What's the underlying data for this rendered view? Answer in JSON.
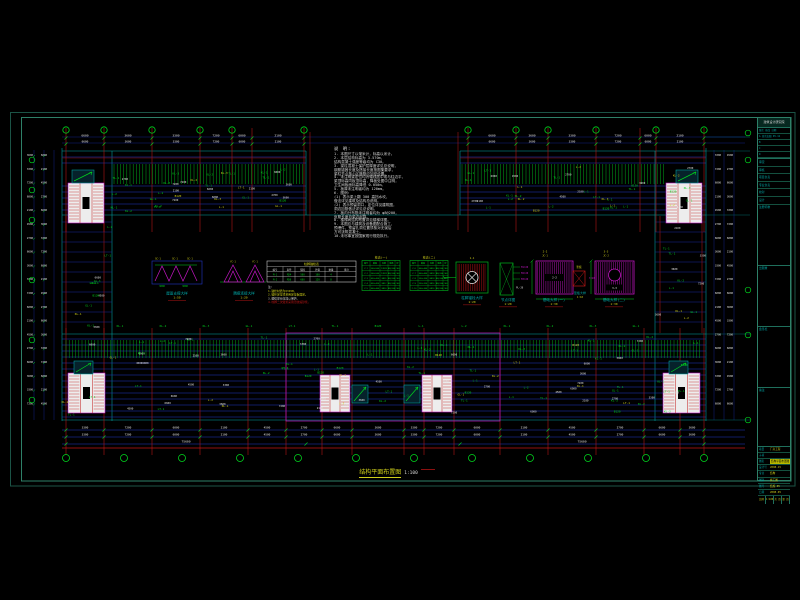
{
  "colors": {
    "bg": "#000000",
    "blue": "#2136c8",
    "blue_dim": "#17279c",
    "cyan": "#00a8a8",
    "teal_outer": "#1b5346",
    "teal_inner": "#2e8068",
    "red": "#c21616",
    "dark_red": "#8c1010",
    "green": "#00b41e",
    "green_bright": "#00d41e",
    "magenta": "#c316c3",
    "yellow": "#cfcf1a",
    "white": "#e0e0e0"
  },
  "notes": {
    "heading": "说 明:",
    "lines": [
      "1. 本图尺寸以毫米计，标高以米计。",
      "2. 本层结构标高为 3.570m，",
      "   结构混凝土强度等级均为 C30。",
      "3. 梁柱混凝土保护层厚度详见总说明，",
      "   钢筋锚固长度及搭接长度按图集要求，",
      "   梁柱节点核心区箍筋应加密设置。",
      "4. 未注明梁定位均为轴线居中或与柱边平，",
      "   梁顶标高同板顶标高，降板处图中注明，",
      "   卫生间板面标高降低 0.050m。",
      "5. 板厚未注明者均为 120mm。",
      "6. 图例:",
      "   (1) 表示梁上翻 300 高挡水坎，",
      "       做法详见建筑及结构总说明。",
      "   (2) 表示预留洞口，定位详见建筑图，",
      "       洞边加筋做法详见总说明。",
      "7. 板内分布筋未注明者均为 φ8@200，",
      "   负筋长度自梁边起算。",
      "8. 楼梯间结构布置详见楼梯详图。",
      "9. 本图应与建筑及设备图配合施工，",
      "   预埋件、预留孔洞位置须核对无误后",
      "   方可浇筑混凝土。",
      "10.未尽事宜按国家现行规范执行。"
    ]
  },
  "title": {
    "text": "结构平面布置图",
    "scale": "1:100"
  },
  "details": {
    "captions": [
      {
        "label": "屋面支撑大样",
        "scale": "1:50"
      },
      {
        "label": "隅撑连接大样",
        "scale": "1:20"
      },
      {
        "label": "柱脚锚栓大样",
        "scale": "1:20"
      },
      {
        "label": "节点详图",
        "scale": "1:20"
      },
      {
        "label": "基础大样(一)",
        "scale": "1:30"
      },
      {
        "label": "垫板大样",
        "scale": "1:10"
      },
      {
        "label": "基础大样(二)",
        "scale": "1:30"
      }
    ],
    "callouts": [
      "1-1",
      "2-2",
      "3-3"
    ],
    "plate_labels": [
      "2-2",
      "3-3"
    ],
    "pad_label": "垫板",
    "pad_note": "t=20"
  },
  "bolt_table": {
    "title": "柱脚锚栓表",
    "headers": [
      "编号",
      "直径",
      "锚固",
      "外露",
      "数量",
      "备注"
    ],
    "rows": [
      [
        "M-1",
        "M24",
        "500",
        "100",
        "4",
        ""
      ],
      [
        "M-2",
        "M30",
        "600",
        "120",
        "8",
        ""
      ]
    ],
    "notes": [
      "注:",
      "1.锚栓材质为Q345B。",
      "2.锚栓定位须采用定位板固定。",
      "3.螺纹部分应加以保护。",
      "4.柱脚二次灌浆采用无收缩砂浆。"
    ]
  },
  "column_tables": [
    {
      "title": "柱表(一)",
      "rows": [
        [
          "编号",
          "截面",
          "纵筋",
          "箍筋",
          "砼"
        ],
        [
          "Z-1",
          "500×500",
          "12Φ25",
          "Φ8@100",
          "C40"
        ],
        [
          "Z-2",
          "500×500",
          "12Φ22",
          "Φ8@100",
          "C40"
        ],
        [
          "Z-3",
          "450×450",
          "8Φ25",
          "Φ8@100",
          "C40"
        ],
        [
          "Z-4",
          "450×450",
          "8Φ22",
          "Φ8@100",
          "C40"
        ],
        [
          "Z-5",
          "400×400",
          "8Φ20",
          "Φ8@100",
          "C40"
        ]
      ]
    },
    {
      "title": "柱表(二)",
      "rows": [
        [
          "编号",
          "截面",
          "纵筋",
          "箍筋",
          "砼"
        ],
        [
          "Z-6",
          "400×400",
          "8Φ20",
          "Φ8@100",
          "C40"
        ],
        [
          "Z-7",
          "400×400",
          "8Φ18",
          "Φ8@100",
          "C40"
        ],
        [
          "Z-8",
          "350×350",
          "8Φ18",
          "Φ8@100",
          "C40"
        ],
        [
          "Z-9",
          "350×350",
          "8Φ16",
          "Φ8@100",
          "C40"
        ],
        [
          "Z-10",
          "300×300",
          "6Φ16",
          "Φ8@100",
          "C40"
        ]
      ]
    }
  ],
  "plan_labels": {
    "beams": [
      "L-1",
      "L-2",
      "KL-1",
      "KL-2",
      "KL-3",
      "GL-1",
      "LT-1",
      "TL-1",
      "B120"
    ],
    "dims": [
      "3600",
      "3300",
      "7200",
      "6000",
      "2100",
      "4500",
      "2700",
      "6600"
    ],
    "total_dim": "75600"
  },
  "titleblock": {
    "header": "建筑设计研究院",
    "rev_rows": [
      [
        "版次",
        "修改",
        "日期"
      ],
      [
        "A",
        "首次出图",
        "05.12"
      ],
      [
        "B",
        "",
        ""
      ],
      [
        "C",
        "",
        ""
      ],
      [
        "D",
        "",
        ""
      ]
    ],
    "fields": [
      "审定",
      "审核",
      "项目负责",
      "专业负责",
      "校对",
      "设计"
    ],
    "boxes": [
      "注册师章",
      "出图章",
      "会签栏",
      "备注"
    ],
    "bottom": [
      {
        "label": "项目",
        "value": "厂房工程",
        "hl": false
      },
      {
        "label": "子项",
        "value": "",
        "hl": false
      },
      {
        "label": "图名",
        "value": "结构平面布置图",
        "hl": true
      },
      {
        "label": "设计号",
        "value": "2008-15",
        "hl": false
      },
      {
        "label": "专业",
        "value": "结构",
        "hl": false
      },
      {
        "label": "图别",
        "value": "施工图",
        "hl": false
      },
      {
        "label": "图号",
        "value": "结施-05",
        "hl": false
      },
      {
        "label": "日期",
        "value": "2008.05",
        "hl": false
      }
    ],
    "grid": [
      "比例",
      "1:100",
      "共 页",
      "第 页"
    ]
  }
}
